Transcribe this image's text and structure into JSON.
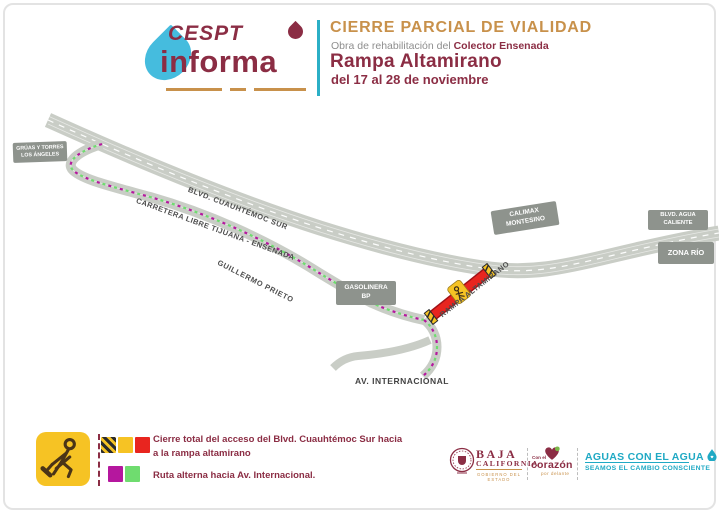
{
  "colors": {
    "maroon": "#8B2D44",
    "gold": "#C8914B",
    "teal": "#2BAFC6",
    "road_gray": "#C9CDC6",
    "place_label_gray": "#8E938D",
    "closure_red": "#E8251F",
    "sign_yellow": "#F6C324",
    "route_magenta": "#B5179E",
    "route_green": "#6FDC6F"
  },
  "header": {
    "logo_top": "CESPT",
    "logo_bottom": "informa",
    "title": "CIERRE PARCIAL DE VIALIDAD",
    "subtitle_prefix": "Obra de rehabilitación del ",
    "subtitle_highlight": "Colector Ensenada",
    "road_name": "Rampa Altamirano",
    "date_range": "del 17 al 28 de noviembre"
  },
  "map": {
    "labels": {
      "blvd_cuauhtemoc": "BLVD. CUAUHTÉMOC SUR",
      "carretera_libre": "CARRETERA LIBRE TIJUANA - ENSENADA",
      "guillermo_prieto": "GUILLERMO PRIETO",
      "rampa_altamirano": "RAMPA ALTAMIRANO",
      "av_internacional": "AV. INTERNACIONAL"
    },
    "places": {
      "gruas_line1": "GRÚAS Y TORRES",
      "gruas_line2": "LOS ÁNGELES",
      "gasolinera_line1": "GASOLINERA",
      "gasolinera_line2": "BP",
      "calimax_line1": "CALIMAX",
      "calimax_line2": "MONTESINO",
      "agua_caliente_line1": "BLVD. AGUA",
      "agua_caliente_line2": "CALIENTE",
      "zona_rio": "ZONA RÍO"
    }
  },
  "legend": {
    "closure_line1": "Cierre total del acceso del Blvd. Cuauhtémoc Sur hacia",
    "closure_line2": "a la rampa altamirano",
    "alternate": "Ruta alterna hacia Av. Internacional."
  },
  "footer": {
    "state_name_line1": "BAJA",
    "state_name_line2": "CALIFORNIA",
    "state_sub": "GOBIERNO DEL ESTADO",
    "heart_top": "Con el",
    "heart_main": "corazón",
    "heart_sub": "por delante",
    "slogan_main": "AGUAS CON EL AGUA",
    "slogan_sub": "SEAMOS EL CAMBIO CONSCIENTE"
  }
}
